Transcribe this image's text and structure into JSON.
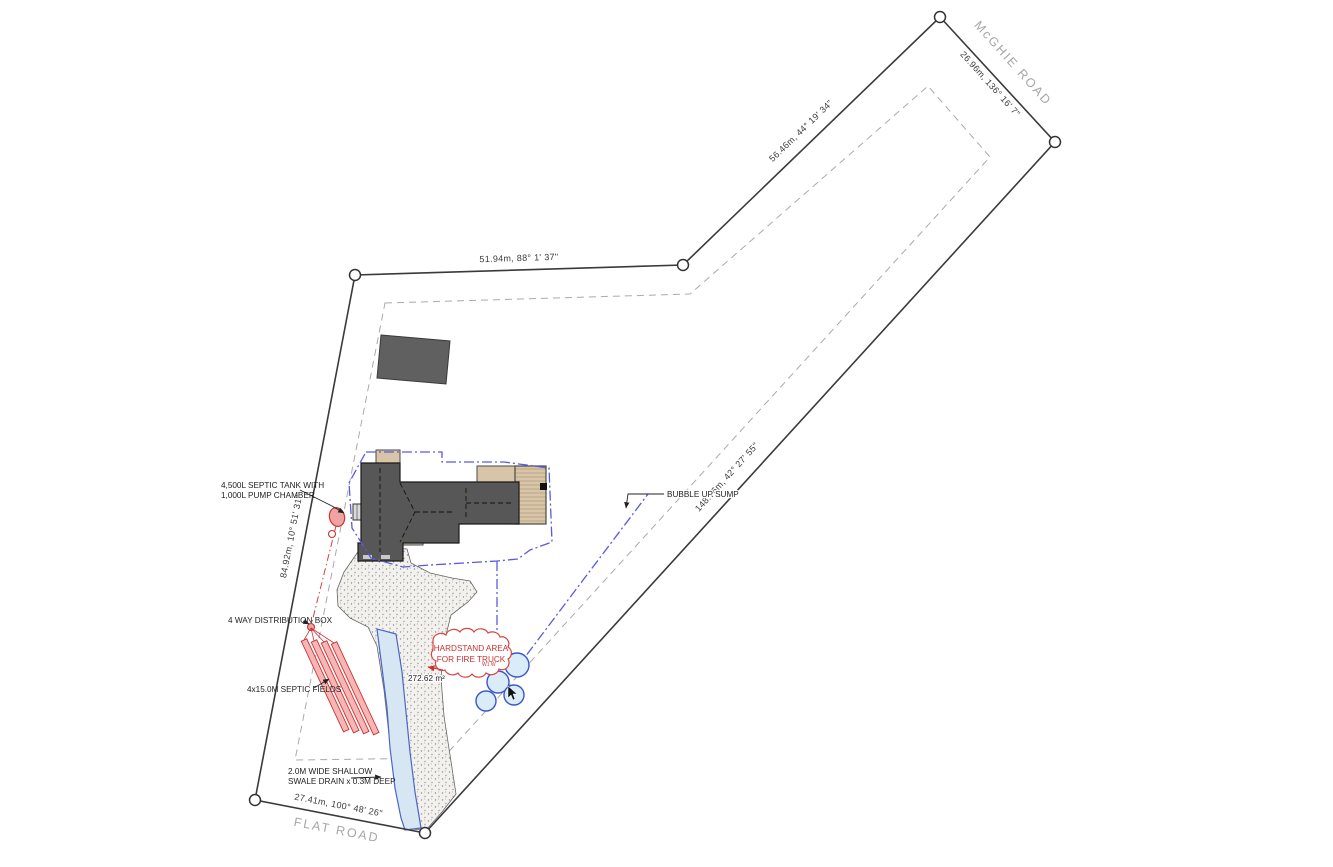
{
  "plan": {
    "roads": {
      "mcghie": "McGHIE ROAD",
      "flat": "FLAT ROAD"
    },
    "dimensions": {
      "north": "51.94m, 88° 1' 37\"",
      "northeast": "56.46m, 44° 19' 34\"",
      "mcghie_frontage": "26.96m, 136° 16' 7\"",
      "southeast": "148.76m, 42° 27' 55\"",
      "south": "27.41m, 100° 48' 26\"",
      "west": "84.92m, 10° 51' 31\""
    },
    "annotations": {
      "septic_tank_line1": "4,500L SEPTIC TANK WITH",
      "septic_tank_line2": "1,000L PUMP CHAMBER",
      "distribution_box": "4 WAY DISTRIBUTION BOX",
      "septic_fields": "4x15.0M SEPTIC FIELDS",
      "swale_line1": "2.0M WIDE SHALLOW",
      "swale_line2": "SWALE DRAIN x 0.3M DEEP",
      "bubble_up_sump": "BUBBLE UP SUMP",
      "hardstand_line1": "HARDSTAND AREA",
      "hardstand_line2": "FOR FIRE TRUCK",
      "hardstand_note": "W1 W",
      "driveway_area": "272.62 m²"
    },
    "colors": {
      "boundary": "#3a3a3a",
      "setback": "#aaaaaa",
      "roof_gray": "#575757",
      "porch_tan": "#d8c5a8",
      "septic_red": "#cc3333",
      "swale_blue": "#4a66c8",
      "envelope_blue": "#5a5ae0",
      "tree_fill": "#d9ecf7"
    }
  }
}
